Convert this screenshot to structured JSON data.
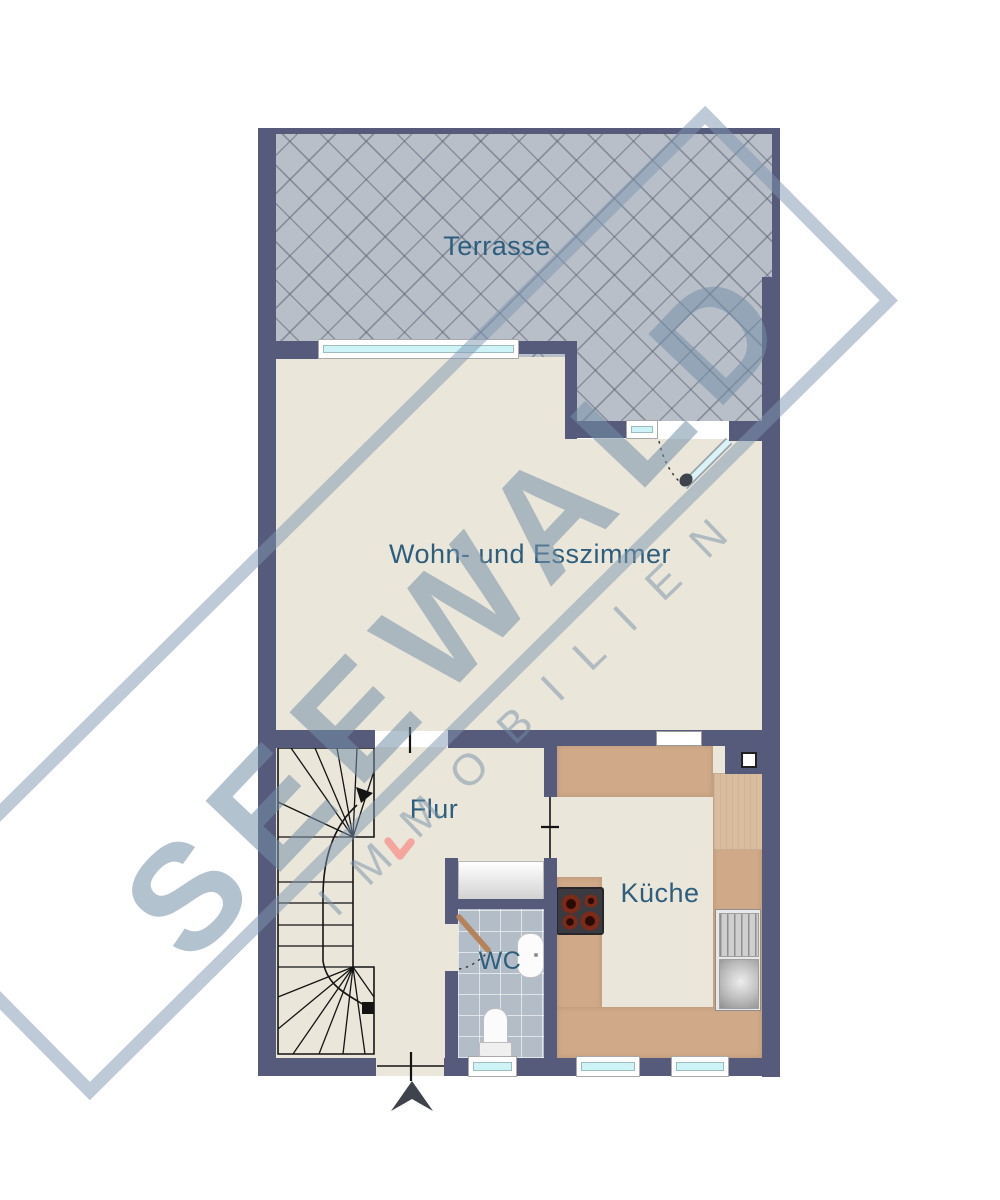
{
  "watermark": {
    "brand": "SEEWALD",
    "tagline": "IMMOBILIEN"
  },
  "rooms": {
    "terrace": {
      "label": "Terrasse"
    },
    "living": {
      "label": "Wohn- und Esszimmer"
    },
    "hall": {
      "label": "Flur"
    },
    "wc": {
      "label": "WC"
    },
    "kitchen": {
      "label": "Küche"
    }
  },
  "colors": {
    "wall": "#565a7b",
    "floor": "#eae6da",
    "terrace_tile": "#b8bfc9",
    "wc_tile": "#b3bdc7",
    "kitchen_counter": "#cfa988",
    "window_glass": "#cdf3f7",
    "room_label": "#2d5e7d",
    "watermark": "#748fa8",
    "entry_marker": "#3f434b",
    "accent_pink": "#f4a69e"
  }
}
